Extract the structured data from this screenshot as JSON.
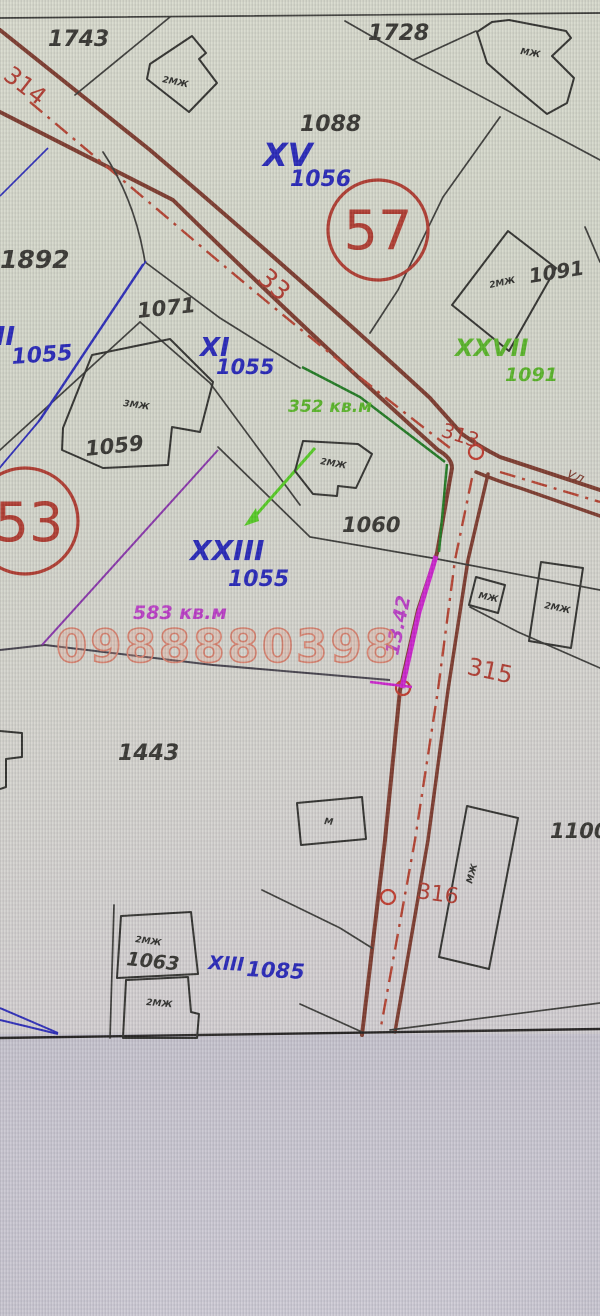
{
  "labels": {
    "parcels": {
      "p1743": "1743",
      "p1728": "1728",
      "p1088": "1088",
      "p1892": "1892",
      "p1071": "1071",
      "p1091": "1091",
      "p1059": "1059",
      "p1060": "1060",
      "p1443": "1443",
      "p1100": "1100",
      "p1063": "1063"
    },
    "lots": {
      "xv_r": "XV",
      "xv_n": "1056",
      "left_r": "III",
      "left_n": "1055",
      "xi_r": "XI",
      "xi_n": "1055",
      "xxiii_r": "XXIII",
      "xxiii_n": "1055",
      "xxvii_r": "XXVII",
      "xxvii_n": "1091",
      "xiii_r": "XIII",
      "xiii_n": "1085"
    },
    "districts": {
      "d57": "57",
      "d53": "53"
    },
    "areas": {
      "green": "352 кв.м",
      "magenta": "583 кв.м"
    },
    "points": {
      "s33": "33",
      "s313": "313",
      "s314": "314",
      "s315": "315",
      "s316": "316"
    },
    "dim": {
      "d1342": "13.42"
    },
    "street": {
      "prefix": "ул."
    },
    "buildings": {
      "t1743": "2МЖ",
      "t1728": "МЖ",
      "t1091": "2МЖ",
      "t1059": "3МЖ",
      "t1060": "2МЖ",
      "tr1": "МЖ",
      "tr2": "2МЖ",
      "tm": "М",
      "t1100": "МЖ",
      "t1063a": "2МЖ",
      "t1063b": "2МЖ"
    }
  },
  "watermark": {
    "phone": "0988880398"
  },
  "palette": {
    "map_background": "#d5d7ca",
    "bottom_band": "#c8c5cf",
    "road_edge": "#7c392b",
    "road_centerline": "#b5402e",
    "boundary_black": "#3a3a36",
    "boundary_blue": "#2a2ab8",
    "boundary_green_dark": "#1f7a1f",
    "boundary_green_bright": "#55cc22",
    "boundary_purple": "#8833aa",
    "boundary_magenta": "#cc22cc",
    "label_black": "#35342f",
    "label_blue": "#2525b8",
    "label_green": "#58b526",
    "label_magenta": "#bb3cc6",
    "marker_red": "#b03a2e",
    "watermark_salmon": "#d8806c"
  }
}
